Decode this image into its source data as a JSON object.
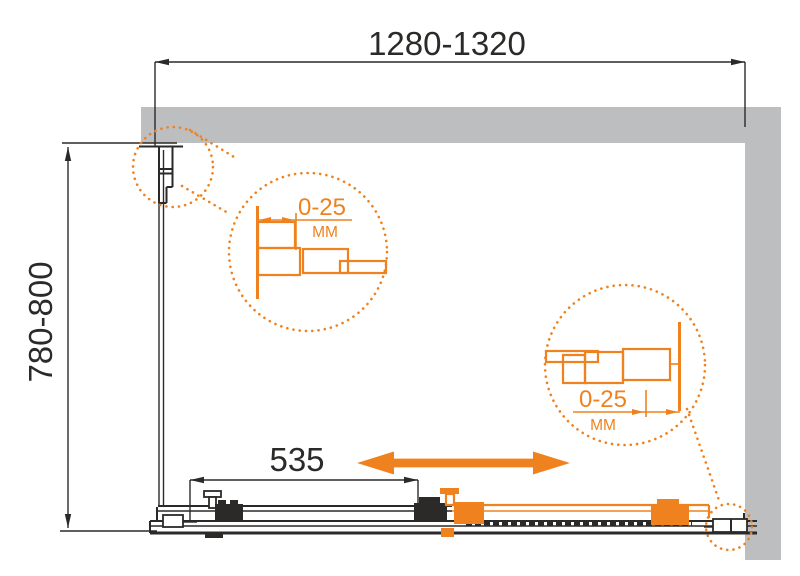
{
  "colors": {
    "accent": "#EF821E",
    "wall": "#BCBEC0",
    "line": "#2B2A29"
  },
  "dimensions": {
    "width_label": "1280-1320",
    "depth_label": "780-800",
    "door_label": "535"
  },
  "callouts": {
    "left": {
      "range": "0-25",
      "unit": "MM"
    },
    "right": {
      "range": "0-25",
      "unit": "MM"
    }
  }
}
